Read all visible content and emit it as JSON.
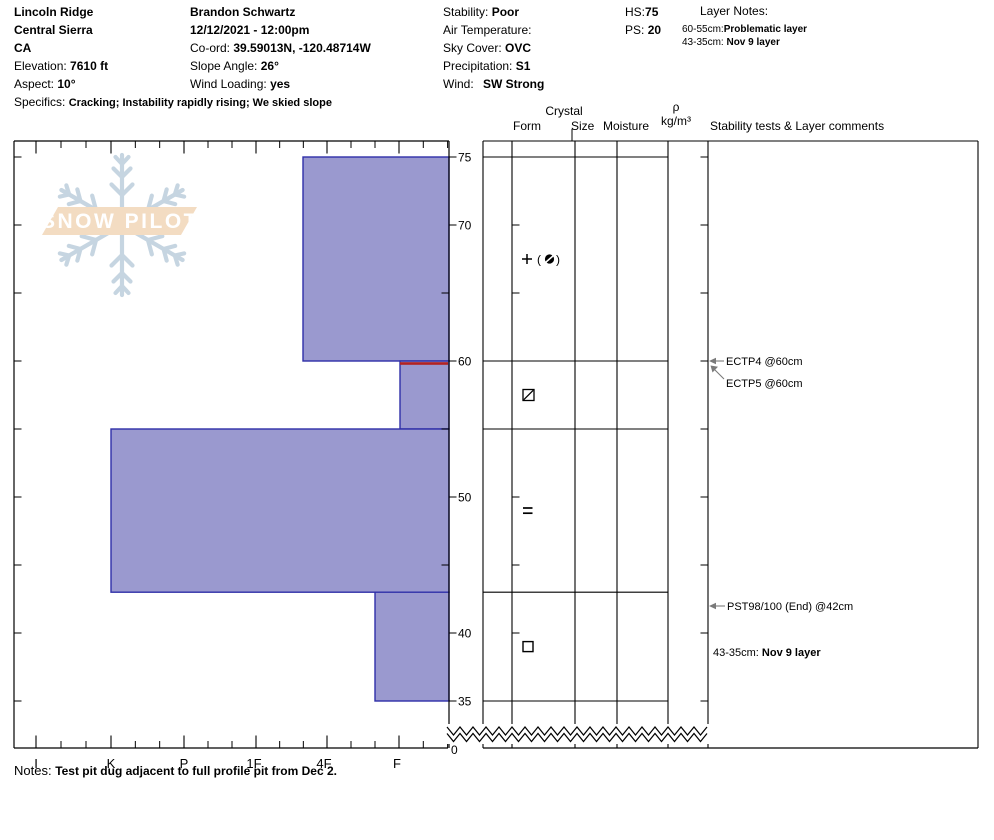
{
  "header": {
    "location": {
      "title": "Lincoln Ridge",
      "region": "Central Sierra",
      "state": "CA",
      "elevation_label": "Elevation: ",
      "elevation_value": "7610 ft",
      "aspect_label": "Aspect: ",
      "aspect_value": "10°",
      "specifics_label": "Specifics: ",
      "specifics_value": "Cracking; Instability rapidly rising; We skied slope"
    },
    "observer": {
      "name": "Brandon Schwartz",
      "datetime": "12/12/2021 - 12:00pm",
      "coord_label": "Co-ord: ",
      "coord_value": "39.59013N, -120.48714W",
      "slope_angle_label": "Slope Angle: ",
      "slope_angle_value": "26°",
      "wind_loading_label": "Wind Loading: ",
      "wind_loading_value": "yes"
    },
    "conditions": {
      "stability_label": "Stability: ",
      "stability_value": "Poor",
      "air_temp_label": "Air Temperature:",
      "sky_cover_label": "Sky Cover: ",
      "sky_cover_value": "OVC",
      "precip_label": "Precipitation: ",
      "precip_value": "S1",
      "wind_label": "Wind: ",
      "wind_value": "SW Strong"
    },
    "totals": {
      "hs_label": "HS:",
      "hs_value": "75",
      "ps_label": "PS: ",
      "ps_value": "20"
    },
    "layer_notes": {
      "title": "Layer Notes:",
      "items": [
        {
          "range": "60-55cm:",
          "note": "Problematic layer"
        },
        {
          "range": "43-35cm: ",
          "note": "Nov 9 layer"
        }
      ]
    }
  },
  "column_headers": {
    "crystal": "Crystal",
    "form": "Form",
    "size": "Size",
    "moisture": "Moisture",
    "rho": "ρ",
    "rho_units": "kg/m³",
    "stability": "Stability tests & Layer comments"
  },
  "watermark": {
    "text": "SNOW PILOT"
  },
  "notes": {
    "label": "Notes: ",
    "text": "Test pit dug adjacent to full profile pit from Dec 2."
  },
  "chart_data": {
    "type": "bar",
    "subtype": "snow-hardness-profile",
    "title": "Snow pit hardness profile",
    "depth_axis": {
      "unit": "cm",
      "side": "right",
      "surface_cm": 75,
      "pit_bottom_cm": 35,
      "tick_labels": [
        75,
        70,
        60,
        50,
        40,
        35
      ],
      "minor_ticks_cm": [
        75,
        70,
        65,
        60,
        55,
        50,
        45,
        40,
        35
      ],
      "unlabeled_right_cm": [
        65,
        55,
        45
      ],
      "bottom_break_label": "0"
    },
    "hardness_axis": {
      "categories": [
        "I",
        "K",
        "P",
        "1F",
        "4F",
        "F"
      ],
      "x_px": [
        36,
        111,
        184,
        256,
        327,
        399
      ],
      "orientation": "harder-left"
    },
    "layers": [
      {
        "top_cm": 75,
        "bottom_cm": 60,
        "hardness": "4F+",
        "left_x_px": 303,
        "grain_form_symbol": "pp-with-rounds",
        "grain_form_text": "+ (●)",
        "flagged": false
      },
      {
        "top_cm": 60,
        "bottom_cm": 55,
        "hardness": "F",
        "left_x_px": 400,
        "grain_form_symbol": "crust-square-slash",
        "grain_form_text": "⧄",
        "flagged": true
      },
      {
        "top_cm": 55,
        "bottom_cm": 43,
        "hardness": "K",
        "left_x_px": 111,
        "grain_form_symbol": "double-bar",
        "grain_form_text": "=",
        "flagged": false
      },
      {
        "top_cm": 43,
        "bottom_cm": 35,
        "hardness": "F+",
        "left_x_px": 375,
        "grain_form_symbol": "facets-square",
        "grain_form_text": "□",
        "flagged": false
      }
    ],
    "flag_line": {
      "depth_cm": 60,
      "x1": 400,
      "x2": 448
    },
    "annotations": [
      {
        "text": "ECTP4 @60cm",
        "x_px": 726,
        "y_px": 361,
        "arrow": "horizontal"
      },
      {
        "text": "ECTP5 @60cm",
        "x_px": 726,
        "y_px": 383,
        "arrow": "diagonal"
      },
      {
        "text": "PST98/100 (End) @42cm",
        "x_px": 727,
        "y_px": 606,
        "arrow": "horizontal"
      },
      {
        "prefix": "43-35cm: ",
        "bold_text": "Nov 9 layer",
        "x_px": 713,
        "y_px": 652,
        "arrow": "none"
      }
    ],
    "colors": {
      "layer_fill": "#9a99cf",
      "layer_border": "#2f2fa8",
      "flag": "#b22222",
      "arrow": "#7a7a7a",
      "grid": "#000000",
      "watermark_band": "#f3dcc2",
      "watermark_flake": "#c6d5e1",
      "watermark_text": "#ffffff"
    }
  }
}
